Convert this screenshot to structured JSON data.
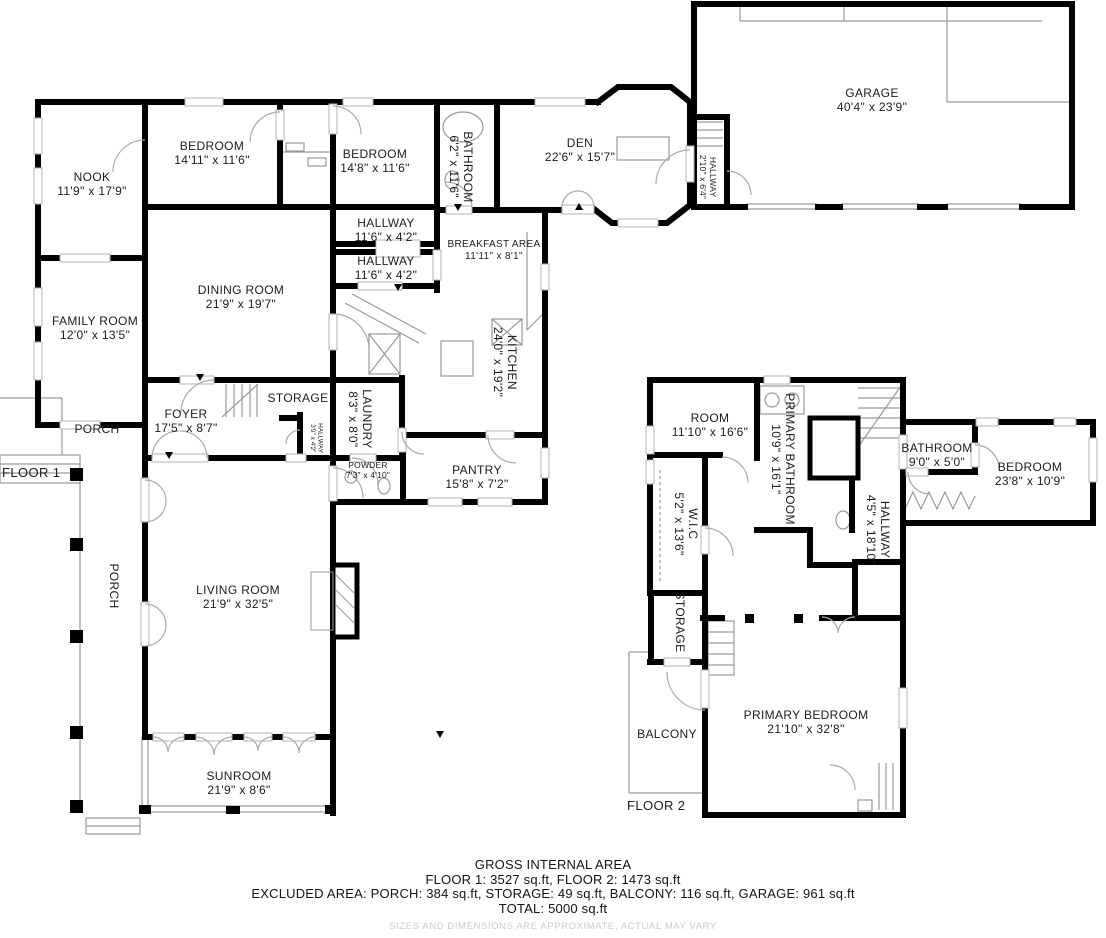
{
  "floor1": {
    "label": "FLOOR 1",
    "rooms": {
      "nook": {
        "name": "NOOK",
        "dims": "11'9\" x 17'9\""
      },
      "bedroom1": {
        "name": "BEDROOM",
        "dims": "14'11\" x 11'6\""
      },
      "bedroom2": {
        "name": "BEDROOM",
        "dims": "14'8\" x 11'6\""
      },
      "bathroom": {
        "name": "BATHROOM",
        "dims": "6'2\" x 11'6\""
      },
      "den": {
        "name": "DEN",
        "dims": "22'6\" x 15'7\""
      },
      "hallway_garage": {
        "name": "HALLWAY",
        "dims": "2'10\" x 6'4\""
      },
      "garage": {
        "name": "GARAGE",
        "dims": "40'4\" x 23'9\""
      },
      "hallway1": {
        "name": "HALLWAY",
        "dims": "11'6\" x 4'2\""
      },
      "hallway2": {
        "name": "HALLWAY",
        "dims": "11'6\" x 4'2\""
      },
      "breakfast_area": {
        "name": "BREAKFAST AREA",
        "dims": "11'11\" x 8'1\""
      },
      "dining_room": {
        "name": "DINING ROOM",
        "dims": "21'9\" x 19'7\""
      },
      "family_room": {
        "name": "FAMILY ROOM",
        "dims": "12'0\" x 13'5\""
      },
      "kitchen": {
        "name": "KITCHEN",
        "dims": "24'0\" x 19'2\""
      },
      "storage": {
        "name": "STORAGE",
        "dims": ""
      },
      "laundry": {
        "name": "LAUNDRY",
        "dims": "8'3\" x 8'0\""
      },
      "hallway_small": {
        "name": "HALLWAY",
        "dims": "3'9\" x 4'2\""
      },
      "foyer": {
        "name": "FOYER",
        "dims": "17'5\" x 8'7\""
      },
      "porch_front": {
        "name": "PORCH",
        "dims": ""
      },
      "powder": {
        "name": "POWDER",
        "dims": "7'3\" x 4'10\""
      },
      "pantry": {
        "name": "PANTRY",
        "dims": "15'8\" x 7'2\""
      },
      "porch_side": {
        "name": "PORCH",
        "dims": ""
      },
      "living_room": {
        "name": "LIVING ROOM",
        "dims": "21'9\" x 32'5\""
      },
      "sunroom": {
        "name": "SUNROOM",
        "dims": "21'9\" x 8'6\""
      }
    }
  },
  "floor2": {
    "label": "FLOOR 2",
    "rooms": {
      "room": {
        "name": "ROOM",
        "dims": "11'10\" x 16'6\""
      },
      "primary_bathroom": {
        "name": "PRIMARY BATHROOM",
        "dims": "10'9\" x 16'1\""
      },
      "bathroom": {
        "name": "BATHROOM",
        "dims": "9'0\" x 5'0\""
      },
      "bedroom": {
        "name": "BEDROOM",
        "dims": "23'8\" x 10'9\""
      },
      "wic": {
        "name": "W.I.C",
        "dims": "5'2\" x 13'6\""
      },
      "hallway": {
        "name": "HALLWAY",
        "dims": "4'5\" x 18'10\""
      },
      "storage": {
        "name": "STORAGE",
        "dims": ""
      },
      "balcony": {
        "name": "BALCONY",
        "dims": ""
      },
      "primary_bedroom": {
        "name": "PRIMARY BEDROOM",
        "dims": "21'10\" x 32'8\""
      }
    }
  },
  "summary": {
    "title": "GROSS INTERNAL AREA",
    "line1": "FLOOR 1: 3527 sq.ft, FLOOR 2: 1473 sq.ft",
    "line2": "EXCLUDED AREA: PORCH: 384 sq.ft, STORAGE: 49 sq.ft, BALCONY: 116 sq.ft, GARAGE: 961 sq.ft",
    "line3": "TOTAL: 5000 sq.ft",
    "disclaimer": "SIZES AND DIMENSIONS ARE APPROXIMATE, ACTUAL MAY VARY"
  }
}
